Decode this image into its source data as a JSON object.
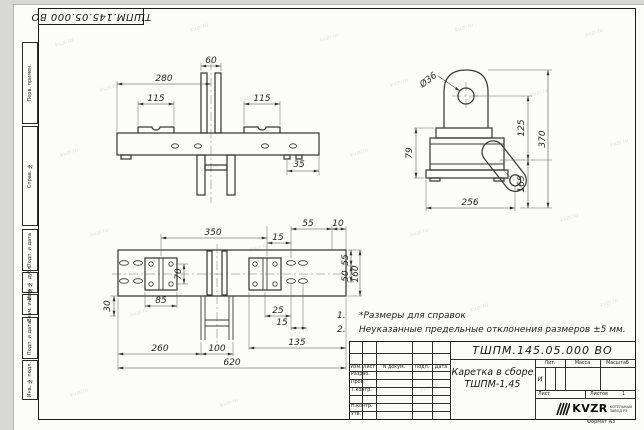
{
  "corner_stamp": {
    "doc_number": "ТШПМ.145.05.000  ВО"
  },
  "side_stamps": {
    "items": [
      "Перв. примен.",
      "Справ. №",
      "Подп. и дата",
      "Инв. № дубл.",
      "Взам. инв. №",
      "Подп. и дата",
      "Инв. № подл."
    ]
  },
  "notes": {
    "n1": "1.",
    "t1": "*Размеры для справок",
    "n2": "2.",
    "t2": "Неуказанные предельные отклонения размеров ±5 мм."
  },
  "dims": {
    "front": {
      "w280": "280",
      "w60": "60",
      "w115l": "115",
      "w115r": "115",
      "w35": "35"
    },
    "side": {
      "dia": "Ø36",
      "h125": "125",
      "h370": "370",
      "h79": "79",
      "h165": "165",
      "w256": "256"
    },
    "plan": {
      "w350": "350",
      "w15a": "15",
      "w55a": "55",
      "w10": "10",
      "h55": "55",
      "h50": "50",
      "h160": "160",
      "h70": "70",
      "w85": "85",
      "h30": "30",
      "w25": "25",
      "w15b": "15",
      "w260": "260",
      "w100": "100",
      "w135": "135",
      "w620": "620"
    }
  },
  "title_block": {
    "doc_number": "ТШПМ.145.05.000  ВО",
    "name_line1": "Каретка в сборе",
    "name_line2": "ТШПМ-1,45",
    "col_izm": "Изм.",
    "col_list": "Лист",
    "col_ndoc": "N докум.",
    "col_podp": "Подп.",
    "col_data": "Дата",
    "row_razrab": "Разраб.",
    "row_prov": "Пров.",
    "row_tkontr": "Т.контр.",
    "row_nkontr": "Н.контр.",
    "row_utv": "Утв.",
    "lit_label": "Лит.",
    "lit_value": "И",
    "mass_label": "Масса",
    "scale_label": "Масштаб",
    "sheet_label": "Лист",
    "sheets_label": "Листов",
    "sheets_value": "1",
    "format_label": "Формат А3",
    "logo_text": "KVZR",
    "logo_sub1": "КОТЕЛЬНЫЙ",
    "logo_sub2": "ЗАВОД РЭ"
  },
  "watermark": {
    "text": "kvzr.ru"
  },
  "colors": {
    "line": "#3a3a3a",
    "sheet": "#fcfcfb",
    "bg": "#d7d7d5"
  }
}
